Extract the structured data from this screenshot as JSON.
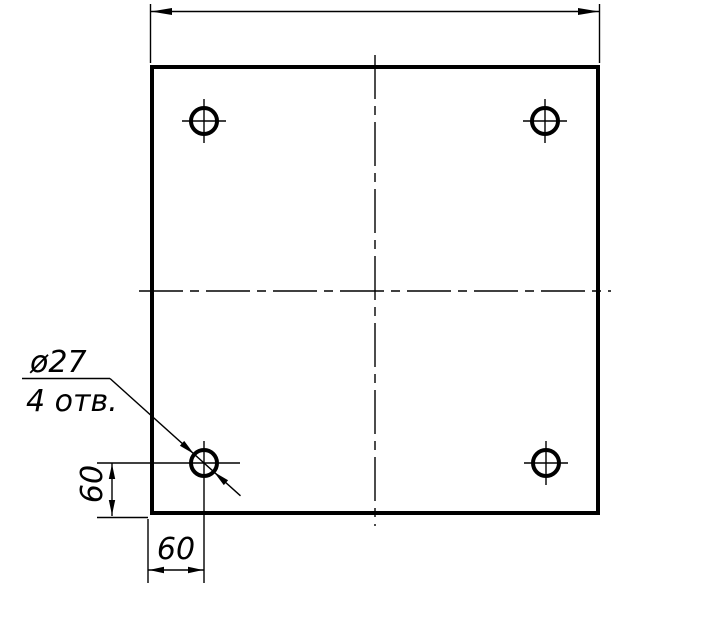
{
  "drawing": {
    "kind": "engineering-drawing-square-plate-with-holes",
    "background_color": "#ffffff",
    "line_color": "#000000",
    "leader_note": {
      "diameter_label": "ø27",
      "holes_count_label": "4 отв."
    },
    "dimensions": {
      "vertical_offset_label": "60",
      "horizontal_offset_label": "60"
    }
  }
}
